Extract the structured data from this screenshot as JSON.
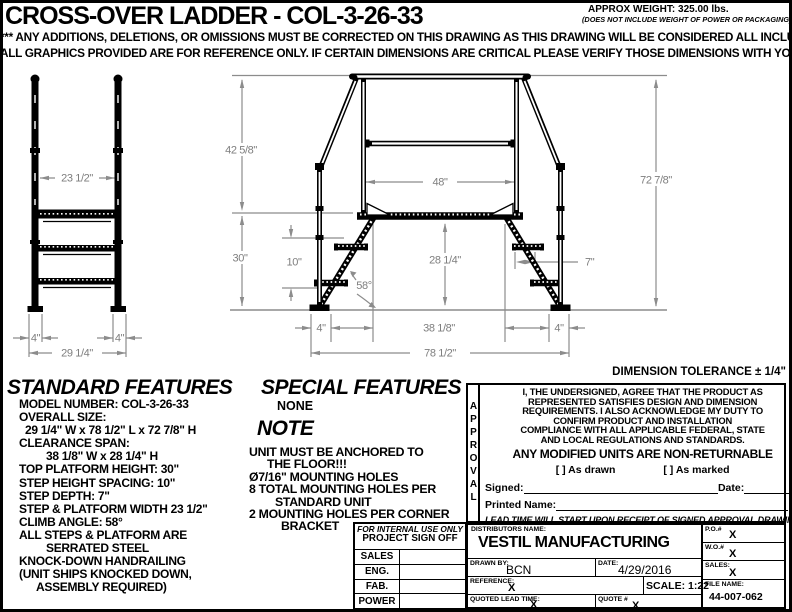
{
  "header": {
    "title": "CROSS-OVER LADDER - COL-3-26-33",
    "weight": "APPROX WEIGHT: 325.00 lbs.",
    "weight_note": "(DOES NOT INCLUDE WEIGHT OF POWER OR PACKAGING)",
    "disclaimer1": "*** ANY ADDITIONS, DELETIONS, OR OMISSIONS MUST BE CORRECTED ON THIS DRAWING AS THIS DRAWING WILL BE CONSIDERED ALL INCLUSIVE ***",
    "disclaimer2": "ALL GRAPHICS PROVIDED ARE FOR REFERENCE ONLY. IF CERTAIN DIMENSIONS ARE CRITICAL PLEASE VERIFY THOSE DIMENSIONS WITH YOUR SALESPERSON"
  },
  "drawing": {
    "tolerance_note": "DIMENSION TOLERANCE ± 1/4\"",
    "front_view": {
      "rail_width": "23 1/2\"",
      "foot_left": "4\"",
      "foot_right": "4\"",
      "overall_width": "29 1/4\""
    },
    "side_view": {
      "upper_height": "42 5/8\"",
      "platform_width": "48\"",
      "platform_height": "30\"",
      "step_spacing": "10\"",
      "climb_angle": "58°",
      "clearance_height": "28 1/4\"",
      "step_depth": "7\"",
      "clearance_span": "38 1/8\"",
      "overall_length": "78 1/2\"",
      "overall_height": "72 7/8\"",
      "foot_left": "4\"",
      "foot_right": "4\""
    }
  },
  "standard_features": {
    "title": "STANDARD FEATURES",
    "items": [
      "MODEL NUMBER: COL-3-26-33",
      "OVERALL SIZE:",
      "29 1/4\" W x 78 1/2\" L x 72 7/8\" H",
      "CLEARANCE SPAN:",
      "38 1/8\" W x 28 1/4\" H",
      "TOP PLATFORM HEIGHT: 30\"",
      "STEP HEIGHT SPACING: 10\"",
      "STEP DEPTH: 7\"",
      "STEP & PLATFORM WIDTH 23 1/2\"",
      "CLIMB ANGLE: 58°",
      "ALL STEPS & PLATFORM ARE",
      "SERRATED STEEL",
      "KNOCK-DOWN HANDRAILING",
      "(UNIT SHIPS KNOCKED DOWN,",
      "ASSEMBLY REQUIRED)"
    ]
  },
  "special_features": {
    "title": "SPECIAL FEATURES",
    "value": "NONE"
  },
  "note": {
    "title": "NOTE",
    "lines": [
      "UNIT MUST BE ANCHORED TO",
      "THE FLOOR!!!",
      "Ø7/16\" MOUNTING HOLES",
      "8 TOTAL MOUNTING HOLES PER",
      "STANDARD UNIT",
      "2 MOUNTING HOLES PER CORNER",
      "BRACKET"
    ]
  },
  "sign_off": {
    "header_line1": "FOR INTERNAL USE ONLY",
    "header_line2": "PROJECT SIGN OFF",
    "rows": [
      "SALES",
      "ENG.",
      "FAB.",
      "POWER"
    ]
  },
  "approval": {
    "vertical_label": "APPROVAL",
    "statement_lines": [
      "I, THE UNDERSIGNED, AGREE THAT THE PRODUCT AS",
      "REPRESENTED SATISFIES DESIGN AND DIMENSION",
      "REQUIREMENTS.  I ALSO ACKNOWLEDGE MY DUTY TO",
      "CONFIRM PRODUCT AND INSTALLATION",
      "COMPLIANCE WITH ALL APPLICABLE FEDERAL, STATE",
      "AND LOCAL REGULATIONS AND STANDARDS."
    ],
    "warning": "ANY MODIFIED UNITS ARE NON-RETURNABLE",
    "as_drawn": "[  ] As drawn",
    "as_marked": "[  ] As marked",
    "signed_label": "Signed:",
    "date_label": "Date:",
    "printed_name_label": "Printed Name:",
    "lead_time_note": "LEAD TIME WILL START UPON RECEIPT OF SIGNED APPROVAL DRAWING"
  },
  "title_block": {
    "distributors_label": "DISTRIBUTORS NAME:",
    "company": "VESTIL MANUFACTURING",
    "po_label": "P.O.#",
    "po_value": "X",
    "wo_label": "W.O.#",
    "wo_value": "X",
    "sales_label": "SALES:",
    "sales_value": "X",
    "drawn_by_label": "DRAWN BY:",
    "drawn_by_value": "BCN",
    "date_label": "DATE:",
    "date_value": "4/29/2016",
    "reference_label": "REFERENCE:",
    "reference_value": "X",
    "scale": "SCALE: 1:22",
    "file_name_label": "FILE NAME:",
    "file_name_value": "44-007-062",
    "lead_time_label": "QUOTED LEAD TIME:",
    "lead_time_value": "X",
    "quote_label": "QUOTE #",
    "quote_value": "X"
  }
}
